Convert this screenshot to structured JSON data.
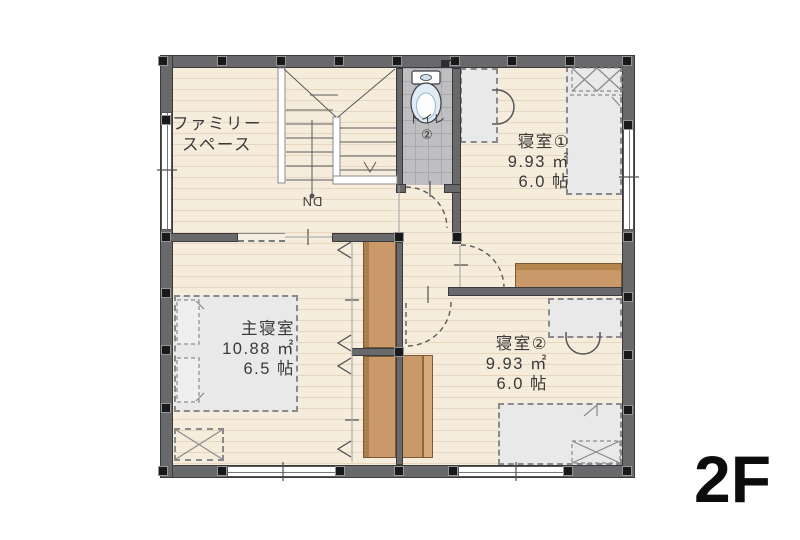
{
  "floor_label": "2F",
  "stairs": {
    "direction": "DN"
  },
  "rooms": {
    "family_space": {
      "name_line1": "ファミリー",
      "name_line2": "スペース"
    },
    "toilet": {
      "name": "トイレ",
      "number": "②"
    },
    "bedroom1": {
      "name": "寝室①",
      "area_sqm": "9.93 ㎡",
      "area_jo": "6.0 帖"
    },
    "bedroom2": {
      "name": "寝室②",
      "area_sqm": "9.93 ㎡",
      "area_jo": "6.0 帖"
    },
    "master_bedroom": {
      "name": "主寝室",
      "area_sqm": "10.88 ㎡",
      "area_jo": "6.5 帖"
    }
  },
  "colors": {
    "wall": "#69696b",
    "floor": "#f6ecdc",
    "floor_line": "#e6d6bf",
    "toilet_tile": "#bfbfc1",
    "closet_wood": "#c9996a",
    "furniture": "#e9e9e9",
    "text": "#3a3a3a",
    "floor_label_text": "#0c0c0c"
  }
}
